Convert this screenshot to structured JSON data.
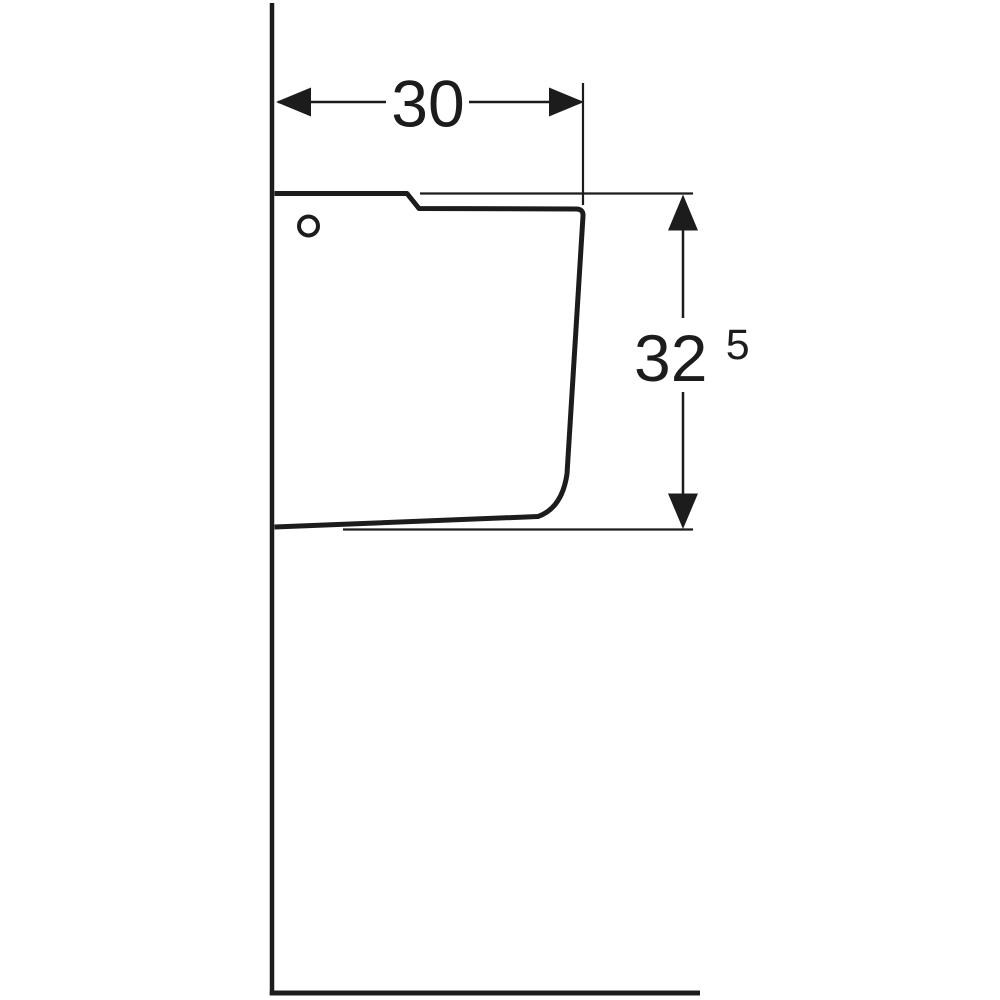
{
  "page": {
    "background_color": "#ffffff"
  },
  "drawing": {
    "type": "technical-dimension-side-view",
    "line_color": "#1c1c1c",
    "labels": {
      "width": "30",
      "height_main": "32",
      "height_sup": "5"
    }
  }
}
